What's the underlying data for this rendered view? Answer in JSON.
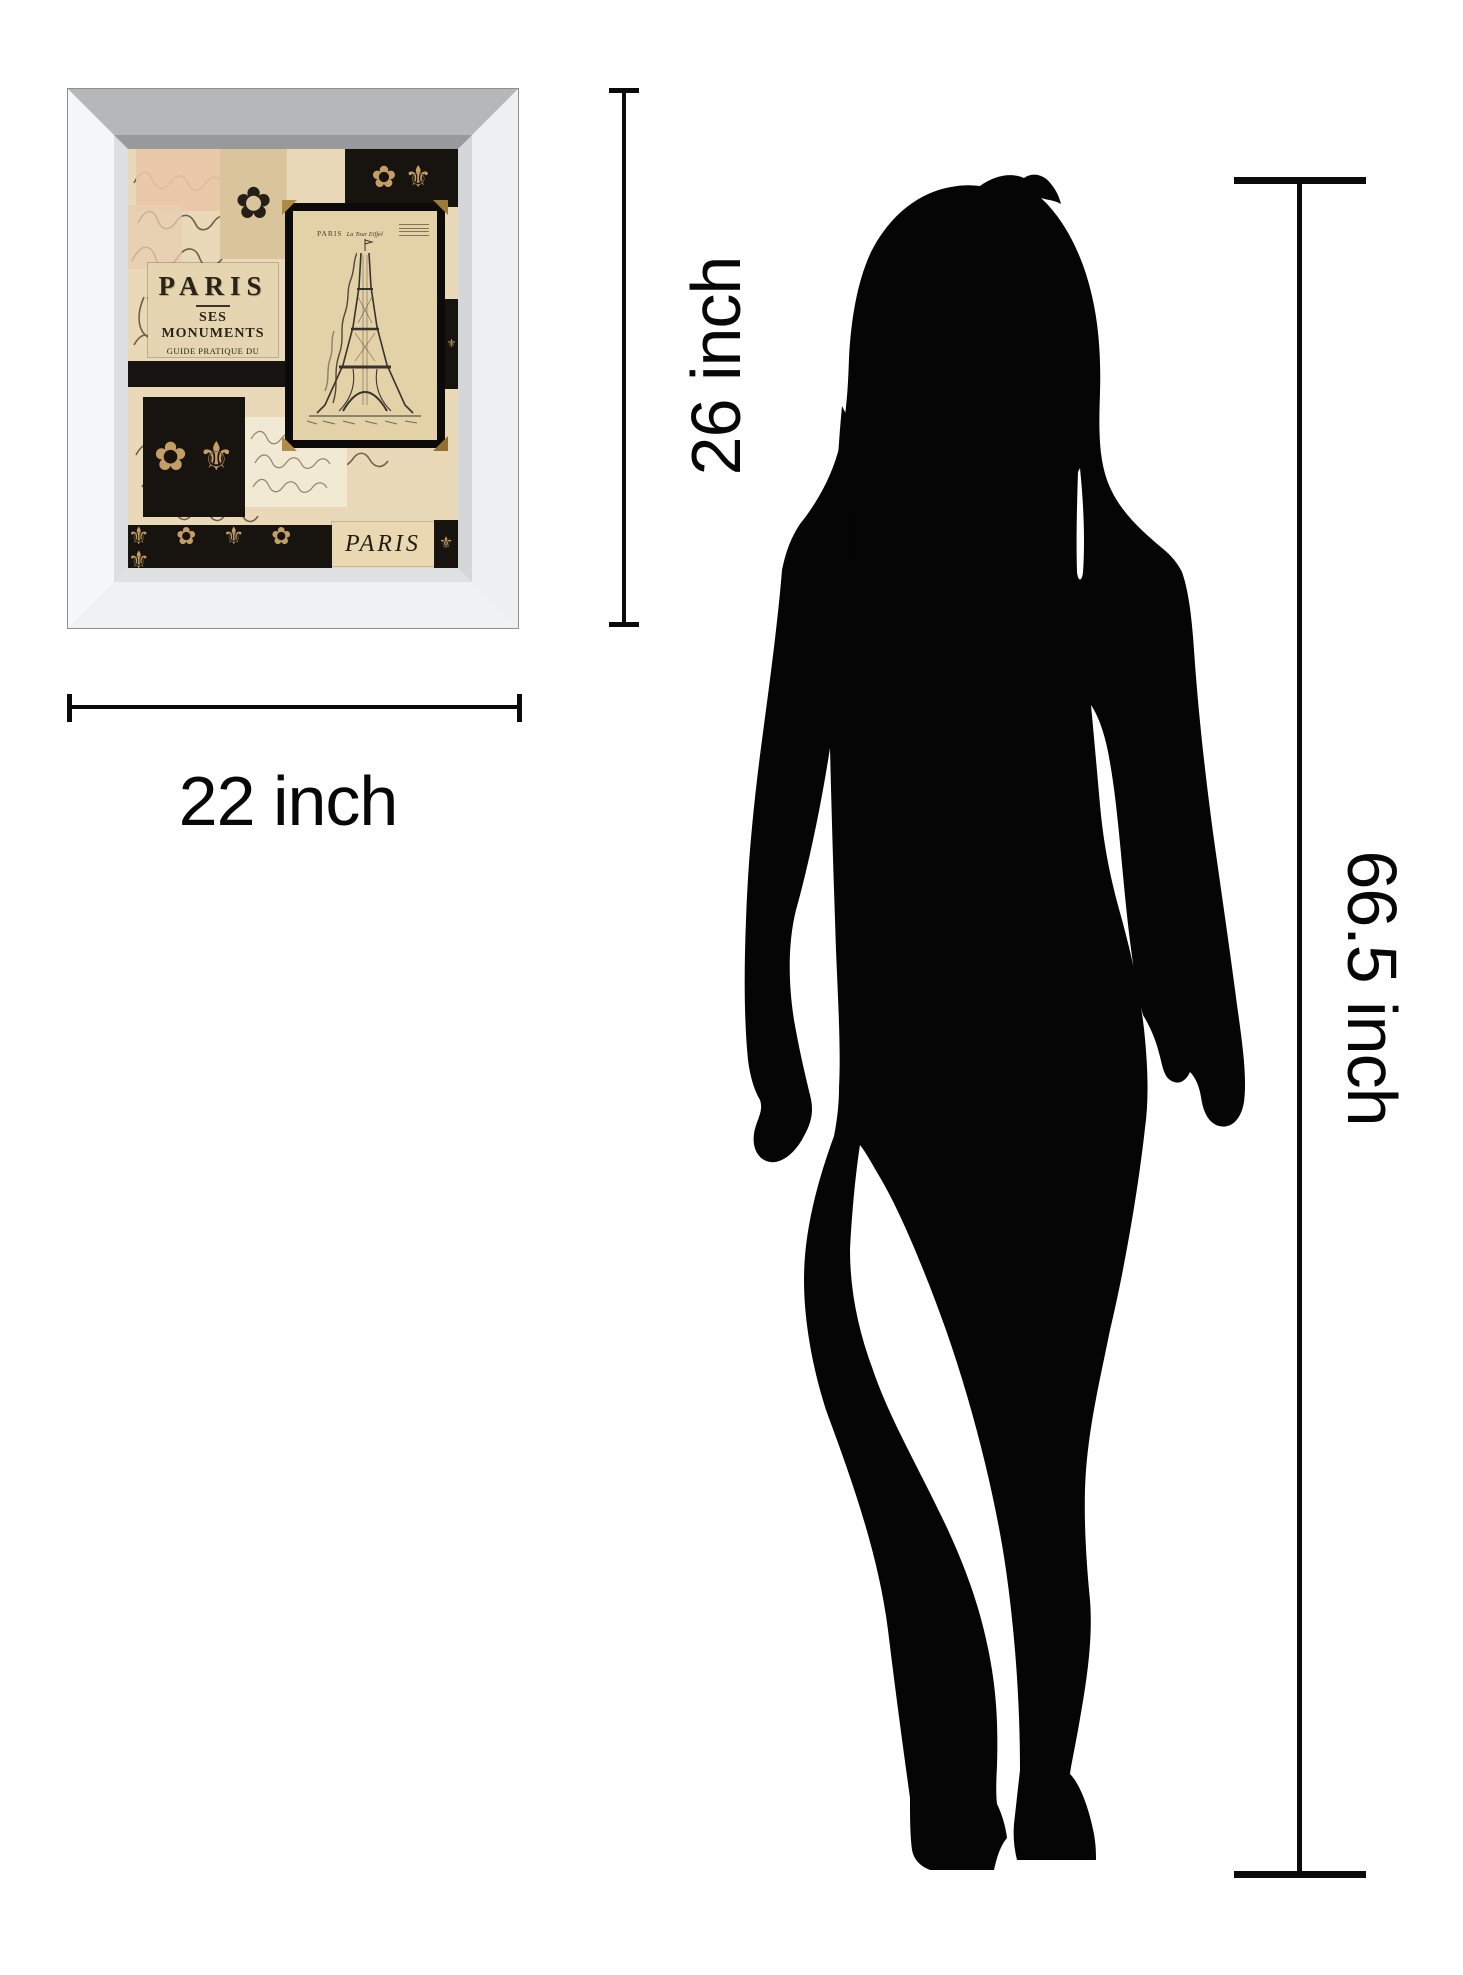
{
  "page": {
    "background": "#ffffff"
  },
  "dimensions": {
    "frame_height_label": "26 inch",
    "frame_width_label": "22 inch",
    "person_height_label": "66.5 inch",
    "line_color": "#0a0a0a"
  },
  "artwork": {
    "frame_color": "#eef0f1",
    "art_background": "#e9d9b8",
    "poster_label": {
      "title": "PARIS",
      "subtitle": "SES MONUMENTS",
      "line3": "GUIDE PRATIQUE DU VISITEUR",
      "line4": "Chemin de fer Métropolitain"
    },
    "postcard": {
      "caption_line1": "PARIS",
      "caption_line2": "La Tour Eiffel"
    },
    "bottom_word": "PARIS",
    "ornaments": {
      "fleur": "⚜",
      "flower": "✿",
      "duo": "✿ ⚜",
      "row": "⚜ ✿ ⚜ ✿ ⚜",
      "single": "✿"
    }
  },
  "silhouette": {
    "color": "#000000"
  }
}
